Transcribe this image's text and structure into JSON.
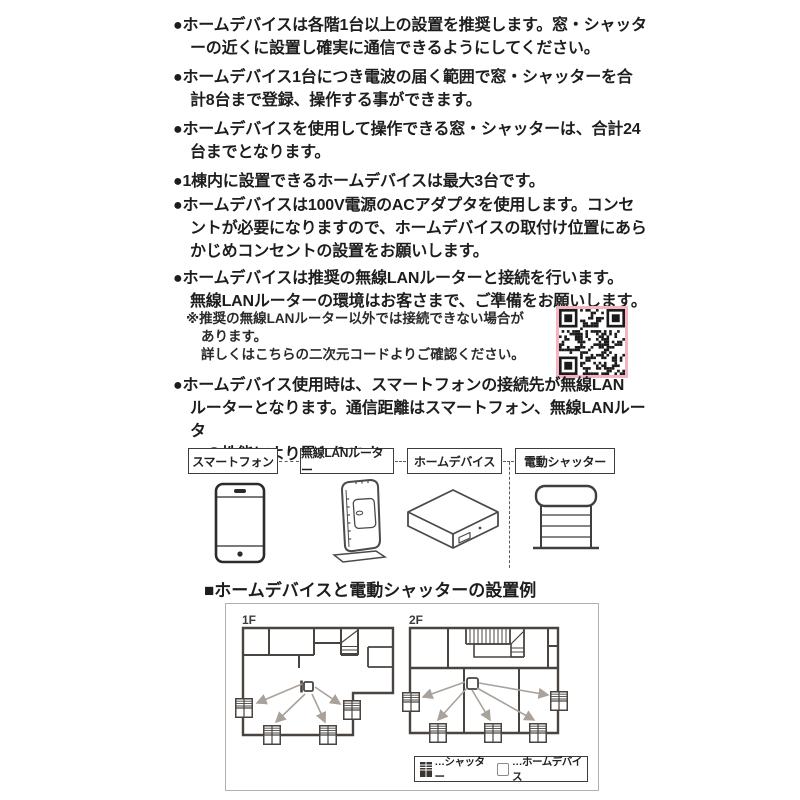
{
  "notes": {
    "items": [
      "ホームデバイスは各階1台以上の設置を推奨します。窓・シャッタ\nーの近くに設置し確実に通信できるようにしてください。",
      "ホームデバイス1台につき電波の届く範囲で窓・シャッターを合\n計8台まで登録、操作する事ができます。",
      "ホームデバイスを使用して操作できる窓・シャッターは、合計24\n台までとなります。",
      "1棟内に設置できるホームデバイスは最大3台です。",
      "ホームデバイスは100V電源のACアダプタを使用します。コンセ\nントが必要になりますので、ホームデバイスの取付け位置にあら\nかじめコンセントの設置をお願いします。",
      "ホームデバイスは推奨の無線LANルーターと接続を行います。\n無線LANルーターの環境はお客さまで、ご準備をお願いします。",
      "ホームデバイス使用時は、スマートフォンの接続先が無線LAN\nルーターとなります。通信距離はスマートフォン、無線LANルータ\nーの性能により異なります。"
    ],
    "footnote": "※推奨の無線LANルーター以外では接続できない場合が\nあります。\n詳しくはこちらの二次元コードよりご確認ください。"
  },
  "flow": {
    "labels": [
      "スマートフォン",
      "無線LANルーター",
      "ホームデバイス",
      "電動シャッター"
    ]
  },
  "example": {
    "heading": "■ホームデバイスと電動シャッターの設置例",
    "floor_labels": [
      "1F",
      "2F"
    ],
    "legend": {
      "shutter": "…シャッター",
      "home_device": "…ホームデバイス"
    }
  },
  "colors": {
    "qr_border": "#f3b3c3",
    "wall": "#4a4440",
    "arrow": "#a8a29b",
    "text": "#1d1d1d"
  }
}
